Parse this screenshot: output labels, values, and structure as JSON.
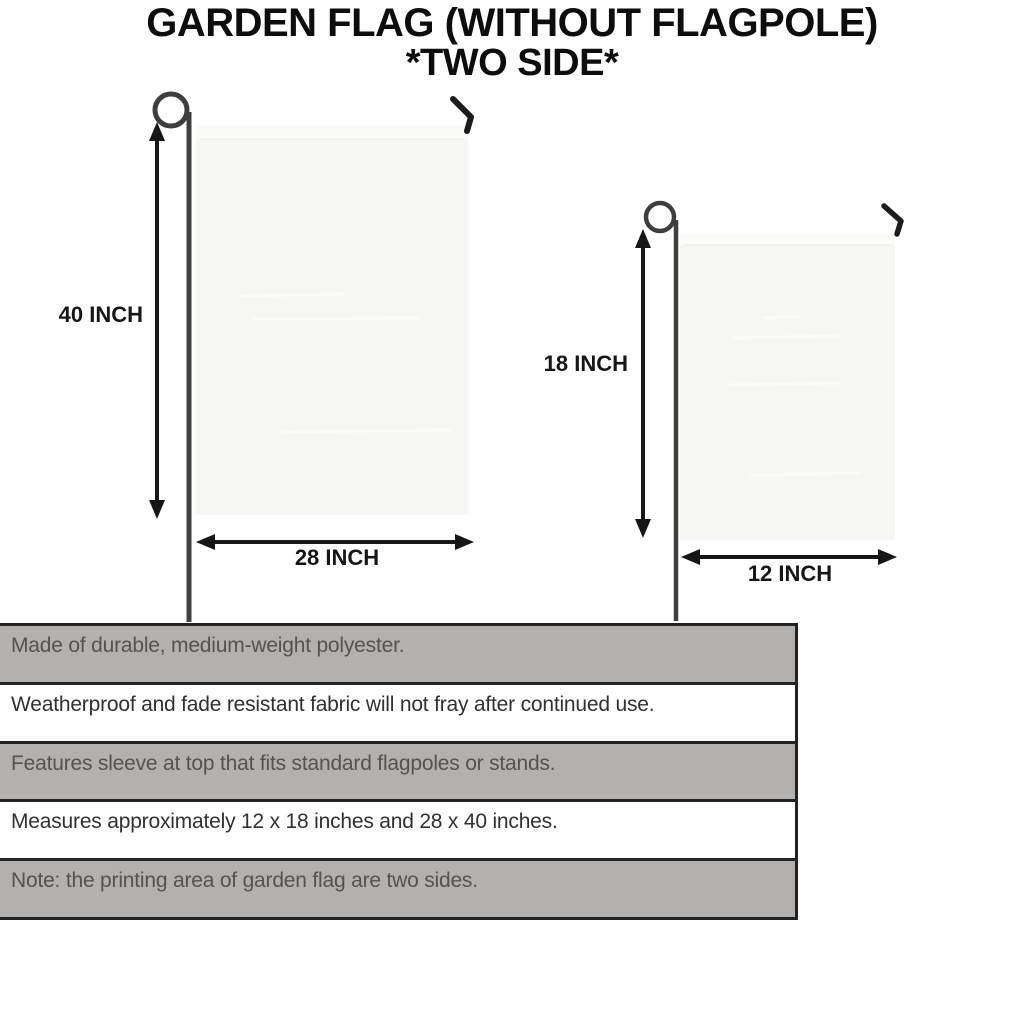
{
  "title": {
    "line1": "GARDEN FLAG (WITHOUT FLAGPOLE)",
    "line2": "*TWO SIDE*"
  },
  "diagram": {
    "large_flag": {
      "name": "28 x 40 inch garden flag",
      "height_label": "40 INCH",
      "width_label": "28 INCH"
    },
    "small_flag": {
      "name": "12 x 18 inch garden flag",
      "height_label": "18 INCH",
      "width_label": "12 INCH"
    }
  },
  "features": [
    "Made of durable, medium-weight polyester.",
    "Weatherproof and fade resistant fabric will not fray after continued use.",
    "Features sleeve at top that fits standard flagpoles or stands.",
    "Measures approximately 12 x 18 inches and 28 x 40 inches.",
    "Note: the printing area of garden flag are two sides."
  ],
  "colors": {
    "flag_fill": "#f6f6f5",
    "flag_sleeve": "#fbfbfa",
    "pole": "#3f3e3c",
    "hook": "#1c1c1c",
    "dimension_arrow": "#161616",
    "row_shaded": "#b2b1b0",
    "row_plain": "#ffffff",
    "row_border": "#232323",
    "title_text": "#0d0d0d"
  }
}
